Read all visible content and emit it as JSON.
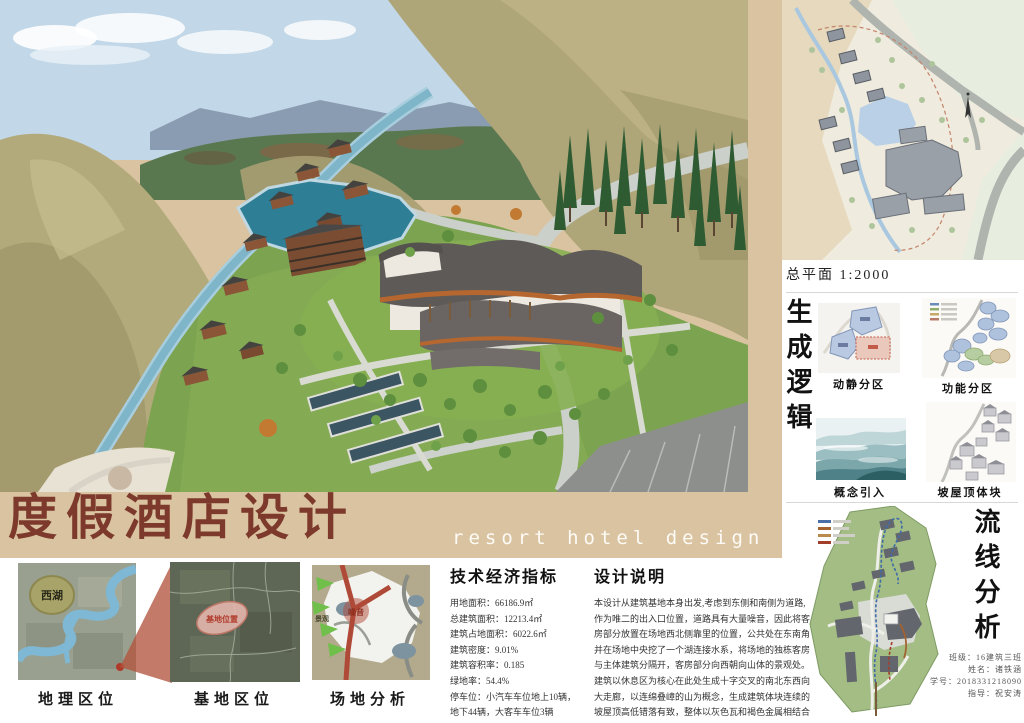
{
  "title": {
    "cn": "度假酒店设计",
    "en": "resort hotel design"
  },
  "site_plan": {
    "caption": "总平面 1:2000"
  },
  "gen_logic": {
    "heading": "生成逻辑",
    "items": [
      {
        "label": "动静分区"
      },
      {
        "label": "功能分区"
      },
      {
        "label": "概念引入"
      },
      {
        "label": "坡屋顶体块"
      }
    ]
  },
  "circulation": {
    "heading": "流线分析"
  },
  "location_maps": {
    "geo": {
      "label": "地理区位",
      "annotation": "西湖"
    },
    "site": {
      "label": "基地区位",
      "annotation": "基地位置"
    },
    "analysis": {
      "label": "场地分析",
      "annotation_left": "景观",
      "annotation_center": "噪音"
    }
  },
  "indicators": {
    "heading": "技术经济指标",
    "items": [
      "用地面积：66186.9㎡",
      "总建筑面积：12213.4㎡",
      "建筑占地面积：6022.6㎡",
      "建筑密度：9.01%",
      "建筑容积率：0.185",
      "绿地率：54.4%",
      "停车位：小汽车车位地上10辆，",
      "地下44辆，大客车车位3辆"
    ]
  },
  "description": {
    "heading": "设计说明",
    "lines": [
      "本设计从建筑基地本身出发,考虑到东侧和南侧为道路,",
      "作为唯二的出入口位置，道路具有大量噪音，因此将客",
      "房部分放置在场地西北侧靠里的位置，公共处在东南角",
      "并在场地中央挖了一个湖连接水系，将场地的独栋客房",
      "与主体建筑分隔开，客房部分向西朝向山体的景观处。",
      "建筑以休息区为核心在此处生成十字交叉的南北东西向",
      "大走廊，以连绵叠嶂的山为概念，生成建筑体块连续的",
      "坡屋顶高低错落有致，整体以灰色瓦和褐色金属相结合"
    ]
  },
  "credits": {
    "lines": [
      "班级：16建筑三班",
      "姓名：诸铁涵",
      "学号：2018331218090",
      "指导：祝安涛"
    ]
  },
  "colors": {
    "frame_tan": "#d9c3a0",
    "title_brown": "#7d3a2c",
    "lake_blue": "#2e7e96",
    "hill_olive": "#b3aa7c",
    "grass_green": "#7ca450"
  }
}
